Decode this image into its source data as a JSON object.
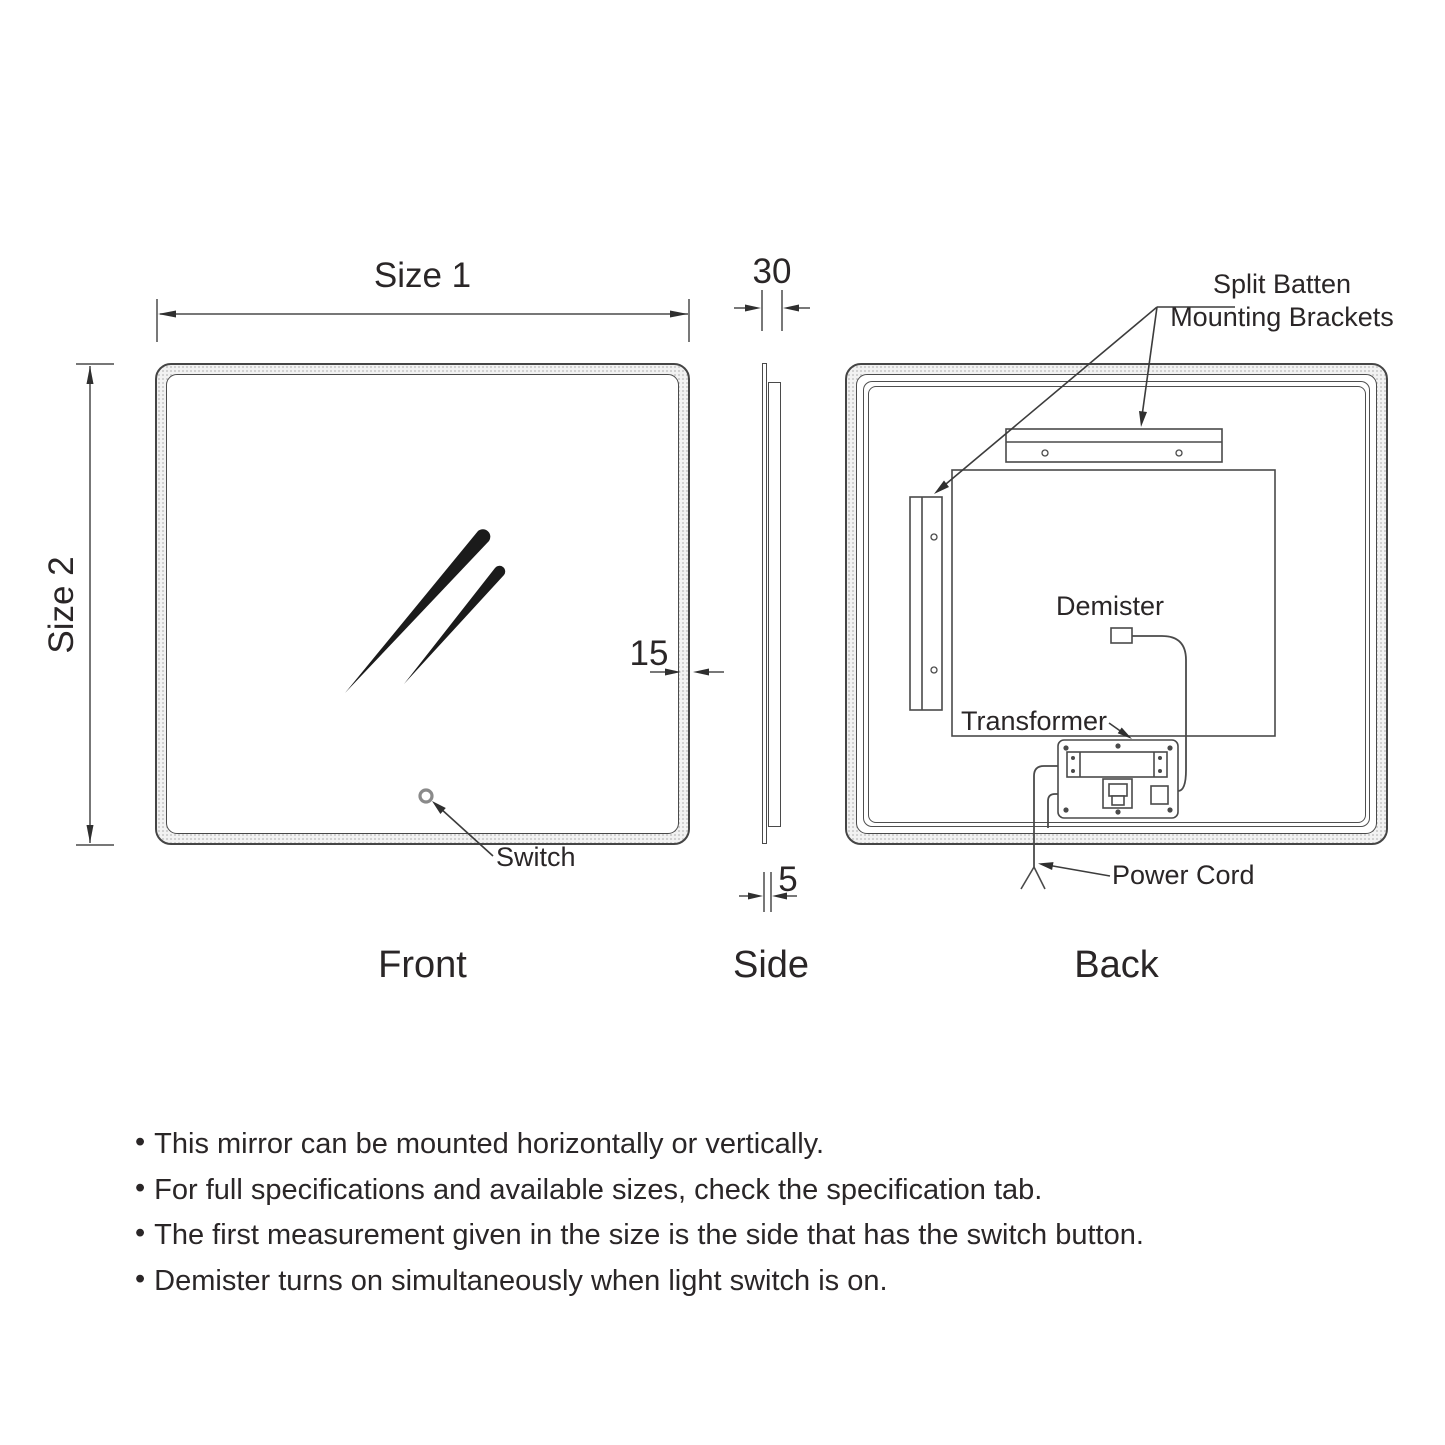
{
  "diagram": {
    "views": {
      "front": "Front",
      "side": "Side",
      "back": "Back"
    },
    "dimensions": {
      "width_label": "Size 1",
      "height_label": "Size 2",
      "depth_mm": "30",
      "frame_mm": "15",
      "glass_mm": "5"
    },
    "components": {
      "split_batten_line1": "Split Batten",
      "split_batten_line2": "Mounting Brackets",
      "demister": "Demister",
      "transformer": "Transformer",
      "switch": "Switch",
      "power_cord": "Power Cord"
    },
    "notes_bullet": "•",
    "notes": [
      "This mirror can be mounted horizontally or vertically.",
      "For full specifications and available sizes, check the specification tab.",
      "The first measurement given in the size is the side that has the switch button.",
      "Demister turns on simultaneously when light switch is on."
    ],
    "colors": {
      "line": "#454545",
      "text": "#2a2627",
      "band": "#f2f2f2",
      "switch_ring": "#8a8a8a"
    }
  }
}
